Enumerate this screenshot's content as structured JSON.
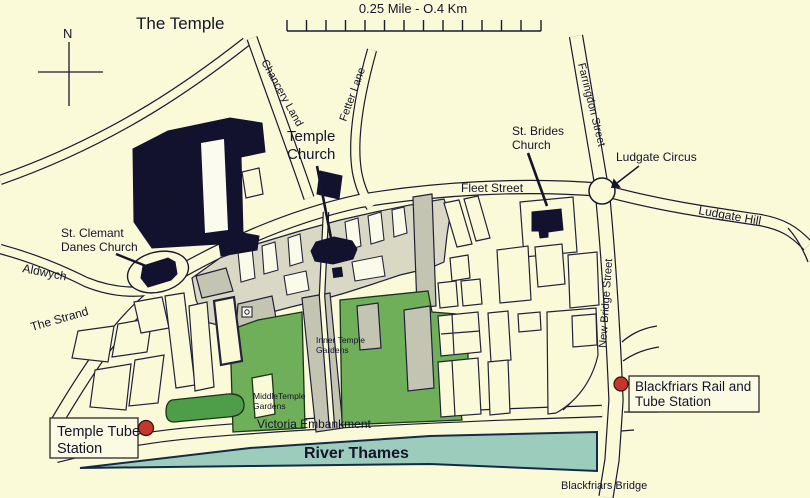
{
  "map": {
    "title": "The Temple",
    "compass_north": "N",
    "scale_label": "0.25 Mile - O.4 Km",
    "streets": {
      "chancery_lane": "Chancery Land",
      "fetter_lane": "Fetter Lane",
      "farringdon_street": "Farringdon Street",
      "fleet_street": "Fleet Street",
      "ludgate_hill": "Ludgate Hill",
      "new_bridge_street": "New Bridge Street",
      "aldwych": "Aldwych",
      "the_strand": "The Strand",
      "victoria_embankment": "Victoria Embankment"
    },
    "landmarks": {
      "royal_courts_line1": "Royal",
      "royal_courts_line2": "Courts of",
      "royal_courts_line3": "Justice",
      "temple_church_line1": "Temple",
      "temple_church_line2": "Church",
      "st_brides_line1": "St. Brides",
      "st_brides_line2": "Church",
      "st_clemant_line1": "St. Clemant",
      "st_clemant_line2": "Danes Church",
      "ludgate_circus": "Ludgate Circus",
      "blackfriars_bridge": "Blackfriars Bridge",
      "river_thames": "River Thames",
      "inner_gardens_line1": "Inner Temple",
      "inner_gardens_line2": "Gardens",
      "middle_gardens_line1": "MiddleTemple",
      "middle_gardens_line2": "Gardens"
    },
    "stations": {
      "temple_line1": "Temple Tube",
      "temple_line2": "Station",
      "blackfriars_line1": "Blackfriars Rail and",
      "blackfriars_line2": "Tube Station"
    },
    "colors": {
      "background": "#FAF9D8",
      "building_navy": "#12122E",
      "complex_gray": "#D9D8C4",
      "building_gray": "#C4C4B2",
      "garden_green": "#6FAF5A",
      "strip_green": "#4E9D48",
      "river_teal": "#9CCCBB",
      "station_red": "#C03A30"
    }
  }
}
